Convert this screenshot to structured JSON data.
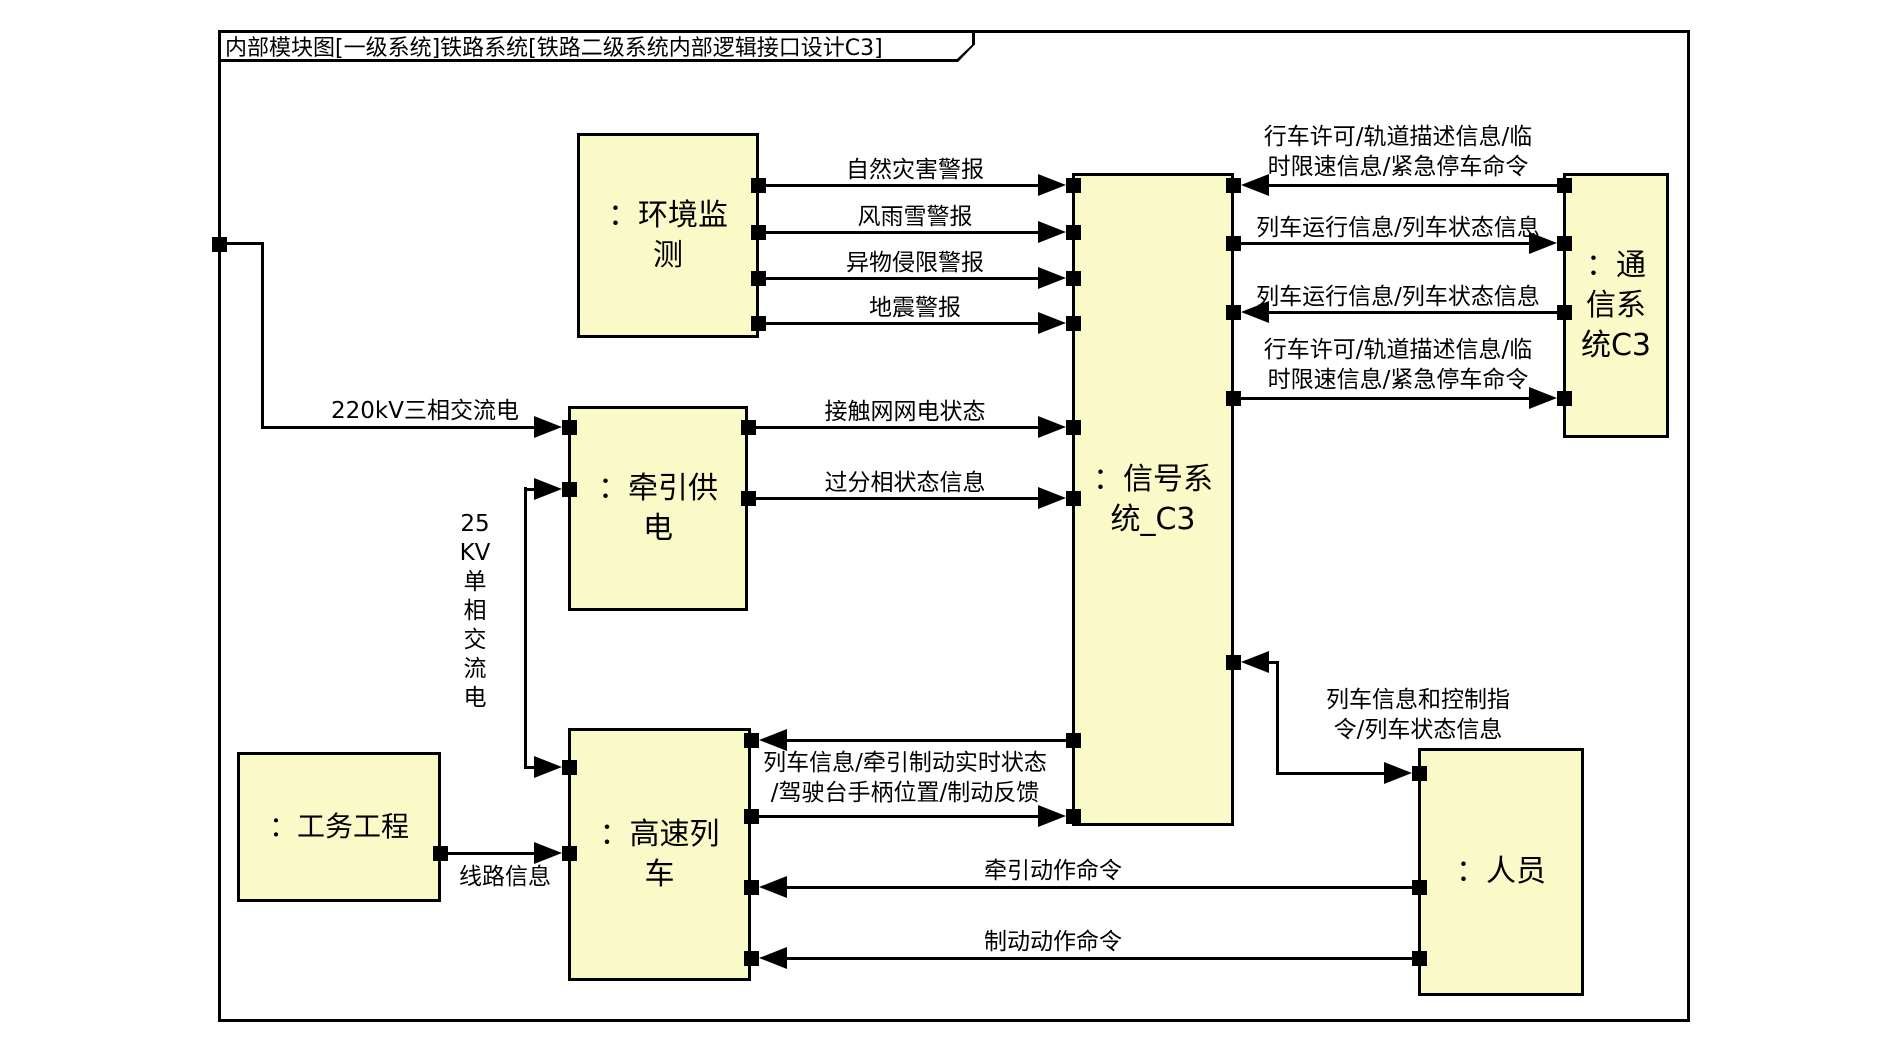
{
  "diagram": {
    "title": "内部模块图[一级系统]铁路系统[铁路二级系统内部逻辑接口设计C3]",
    "colors": {
      "block_fill": "#FAFAC8",
      "line": "#000000",
      "background": "#FFFFFF"
    },
    "blocks": {
      "environment": {
        "label": "：环境监\n测"
      },
      "traction": {
        "label": "：牵引供\n电"
      },
      "civil": {
        "label": "：工务工程"
      },
      "train": {
        "label": "：高速列\n车"
      },
      "signal": {
        "label": "：信号系\n统_C3"
      },
      "comm": {
        "label": "：通\n信系\n统C3"
      },
      "personnel": {
        "label": "：人员"
      }
    },
    "flows": {
      "power_220kv": "220kV三相交流电",
      "power_25kv": "25\nKV\n单\n相\n交\n流\n电",
      "line_info": "线路信息",
      "natural_disaster": "自然灾害警报",
      "wind_rain_snow": "风雨雪警报",
      "foreign_object": "异物侵限警报",
      "earthquake": "地震警报",
      "catenary_status": "接触网网电状态",
      "phase_status": "过分相状态信息",
      "train_feedback": "列车信息/牵引制动实时状态\n/驾驶台手柄位置/制动反馈",
      "movement_authority_top": "行车许可/轨道描述信息/临\n时限速信息/紧急停车命令",
      "train_run_info_out": "列车运行信息/列车状态信息",
      "train_run_info_in": "列车运行信息/列车状态信息",
      "movement_authority_bottom": "行车许可/轨道描述信息/临\n时限速信息/紧急停车命令",
      "train_control_info": "列车信息和控制指\n令/列车状态信息",
      "traction_cmd": "牵引动作命令",
      "brake_cmd": "制动动作命令"
    }
  }
}
